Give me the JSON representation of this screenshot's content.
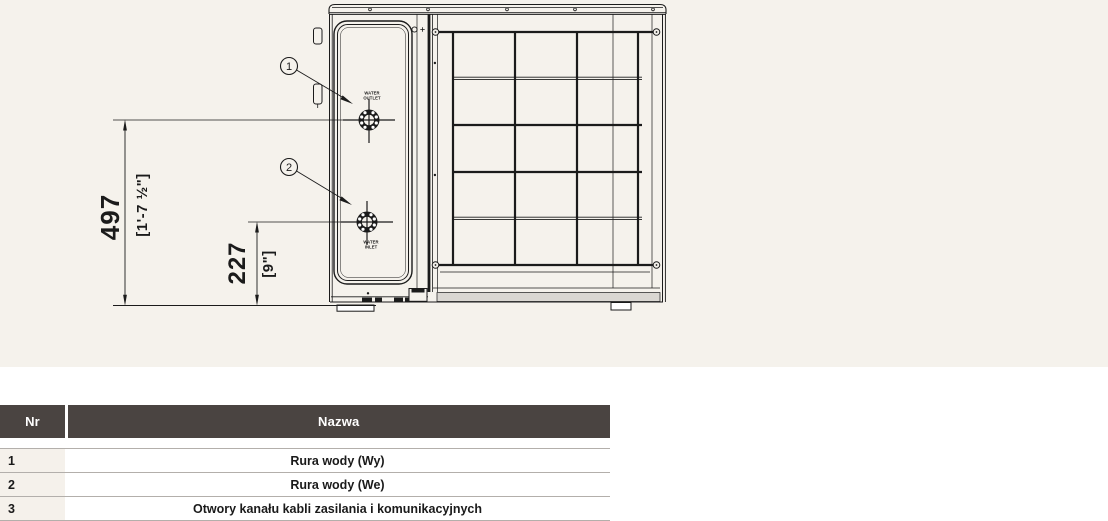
{
  "colors": {
    "diagram_background": "#f5f2ec",
    "drawing_line": "#1b1b1b",
    "table_header_background": "#4a4441",
    "table_header_text": "#ffffff",
    "table_nr_cell_background": "#f5f1eb",
    "table_row_border": "#b3afab"
  },
  "diagram": {
    "callouts": [
      {
        "number": "1"
      },
      {
        "number": "2"
      }
    ],
    "dimensions": {
      "total_height": {
        "mm": "497",
        "imperial": "[1'-7 ½\"]"
      },
      "lower_height": {
        "mm": "227",
        "imperial": "[9\"]"
      }
    },
    "port_labels": {
      "outlet_line1": "WATER",
      "outlet_line2": "OUTLET",
      "inlet_line1": "WATER",
      "inlet_line2": "INLET"
    }
  },
  "table": {
    "headers": {
      "nr": "Nr",
      "nazwa": "Nazwa"
    },
    "rows": [
      {
        "nr": "1",
        "nazwa": "Rura wody (Wy)"
      },
      {
        "nr": "2",
        "nazwa": "Rura wody (We)"
      },
      {
        "nr": "3",
        "nazwa": "Otwory kanału kabli zasilania i komunikacyjnych"
      }
    ]
  }
}
